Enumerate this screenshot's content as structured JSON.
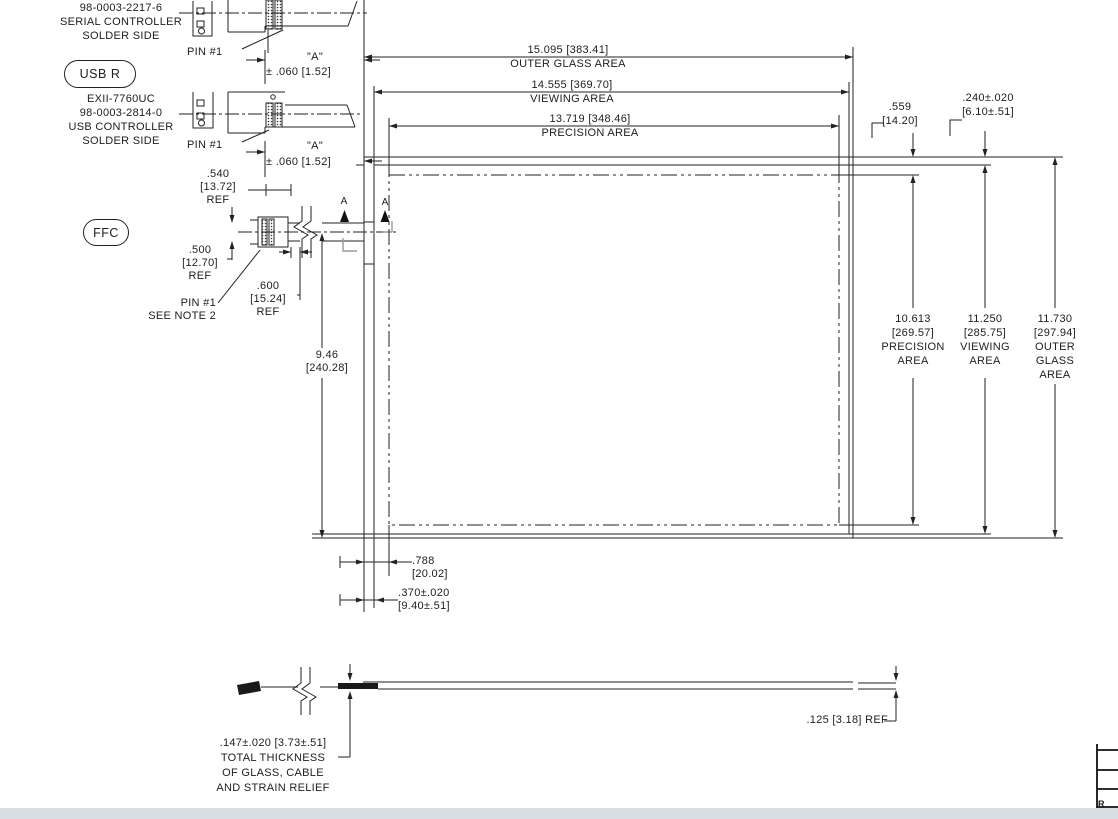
{
  "colors": {
    "line": "#222222",
    "gray_mark": "#9a9a9a",
    "band": "#d8dce3"
  },
  "callouts": {
    "serial_block": "98-0003-2217-6\nSERIAL CONTROLLER\nSOLDER SIDE",
    "usb_badge": "USB R",
    "usb_block": "EXII-7760UC\n98-0003-2814-0\nUSB CONTROLLER\nSOLDER SIDE",
    "ffc_badge": "FFC",
    "pin1_serial": "PIN #1",
    "pin1_usb": "PIN #1",
    "pin1_ffc": "PIN #1\nSEE NOTE 2"
  },
  "dims": {
    "a_serial_name": "\"A\"",
    "a_serial_tol": "± .060 [1.52]",
    "a_usb_name": "\"A\"",
    "a_usb_tol": "± .060 [1.52]",
    "ref540": ".540\n[13.72]\nREF",
    "ref500": ".500\n[12.70]\nREF",
    "ref600": ".600\n[15.24]\nREF",
    "height946": "9.46\n[240.28]",
    "top": [
      {
        "value": "15.095 [383.41]",
        "label": "OUTER GLASS AREA"
      },
      {
        "value": "14.555 [369.70]",
        "label": "VIEWING AREA"
      },
      {
        "value": "13.719 [348.46]",
        "label": "PRECISION AREA"
      }
    ],
    "offset_precision": ".559\n[14.20]",
    "offset_viewing": ".240±.020\n[6.10±.51]",
    "right": [
      {
        "text": "10.613\n[269.57]\nPRECISION\nAREA"
      },
      {
        "text": "11.250\n[285.75]\nVIEWING\nAREA"
      },
      {
        "text": "11.730\n[297.94]\nOUTER\nGLASS\nAREA"
      }
    ],
    "bottom_precision": ".788\n[20.02]",
    "bottom_viewing": ".370±.020\n[9.40±.51]",
    "thickness_ref": ".125 [3.18] REF",
    "thickness_total": ".147±.020 [3.73±.51]\nTOTAL THICKNESS\nOF GLASS, CABLE\nAND STRAIN RELIEF"
  },
  "section": {
    "mark": "A"
  },
  "title_block": {
    "rev_label": "R"
  }
}
